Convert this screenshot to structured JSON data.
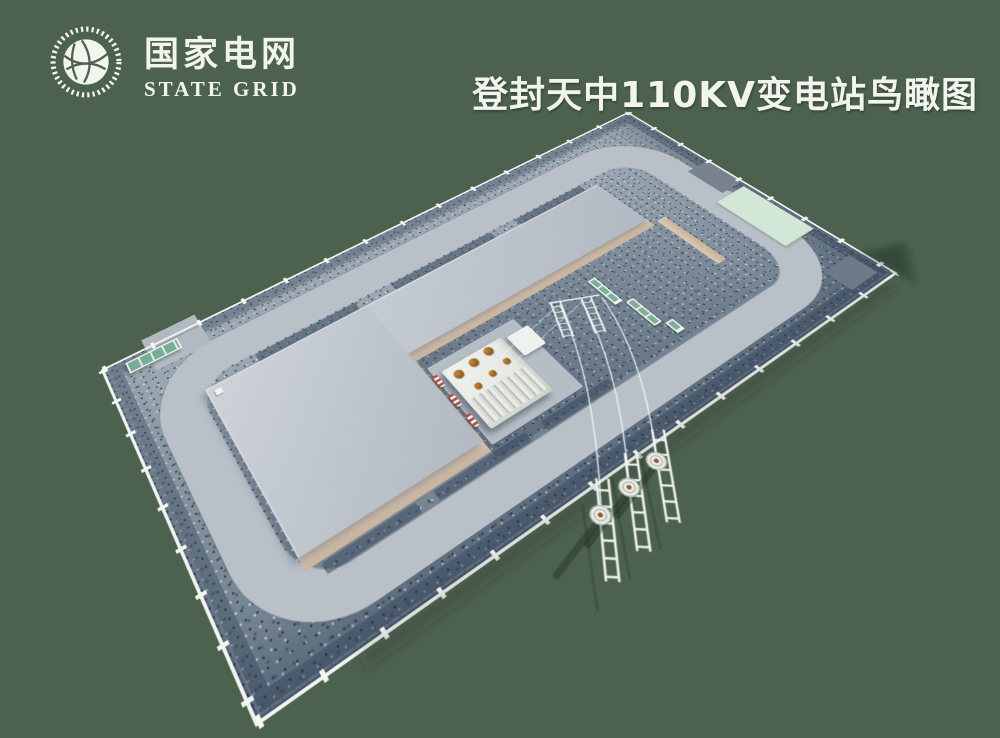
{
  "page": {
    "width": 1000,
    "height": 738,
    "background_color": "#4d624e"
  },
  "header": {
    "logo": {
      "name_cn": "国家电网",
      "name_en": "STATE GRID"
    },
    "title": "登封天中110KV变电站鸟瞰图",
    "title_color": "#f2f4ee"
  },
  "scene": {
    "type": "3d-aerial-rendering",
    "subject": "110kV substation compound bird's-eye view",
    "colors": {
      "background": "#4d624e",
      "gravel_yard": "#8b99a6",
      "loop_road": "#b9c0c8",
      "building_roof": "#c3c9d0",
      "brick_wall": "#d6c5b2",
      "perimeter_fence": "#f1f4f0",
      "entrance_gate": "#79ab99",
      "transformer": "#eceee9",
      "bushing": "#a9701f",
      "equipment_fence": "#7fae9b",
      "mint_pad": "#d3e7d8"
    },
    "elements": [
      "perimeter-fence",
      "loop-road",
      "entrance-gate",
      "l-shaped-building",
      "transformer-yard",
      "main-transformer",
      "surge-arresters",
      "equipment-fences",
      "terminal-poles",
      "incoming-lines",
      "auxiliary-pads"
    ]
  }
}
